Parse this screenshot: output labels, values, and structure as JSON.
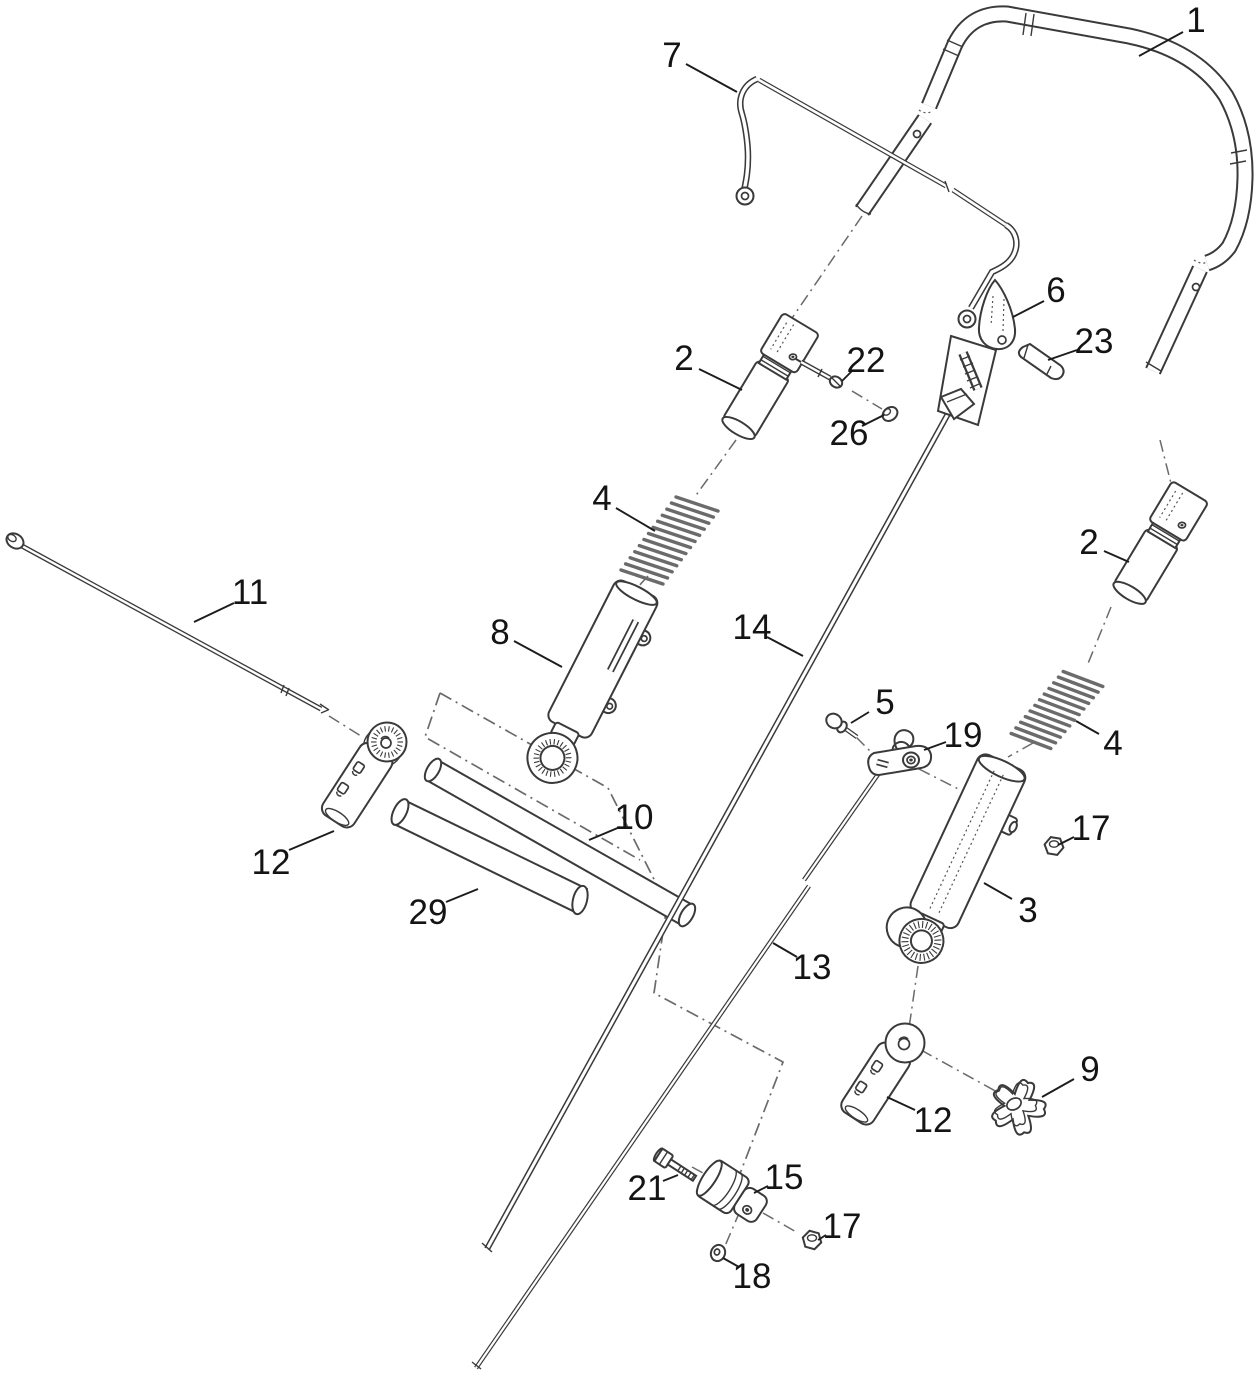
{
  "colors": {
    "background": "#ffffff",
    "line": "#3a3a3a",
    "phantom": "#6a6a6a",
    "label_text": "#141414",
    "spring": "#6b6b6b"
  },
  "callouts": [
    {
      "label": "1",
      "part": "upper-handle",
      "x": 1196,
      "y": 20,
      "l": [
        1183,
        32,
        1139,
        56
      ]
    },
    {
      "label": "7",
      "part": "bail-rod",
      "x": 672,
      "y": 55,
      "l": [
        686,
        64,
        737,
        92
      ]
    },
    {
      "label": "6",
      "part": "cam-lever",
      "x": 1056,
      "y": 290,
      "l": [
        1044,
        301,
        1013,
        317
      ]
    },
    {
      "label": "23",
      "part": "clevis-pin",
      "x": 1094,
      "y": 341,
      "l": [
        1077,
        350,
        1048,
        360
      ]
    },
    {
      "label": "2",
      "part": "trunnion-sleeve-left",
      "x": 684,
      "y": 358,
      "l": [
        699,
        369,
        742,
        390
      ]
    },
    {
      "label": "22",
      "part": "detent-pin",
      "x": 866,
      "y": 360,
      "l": [
        852,
        371,
        842,
        381
      ]
    },
    {
      "label": "26",
      "part": "push-cap",
      "x": 849,
      "y": 433,
      "l": [
        862,
        426,
        884,
        415
      ]
    },
    {
      "label": "4",
      "part": "spring-left",
      "x": 602,
      "y": 498,
      "l": [
        616,
        508,
        655,
        531
      ]
    },
    {
      "label": "2",
      "part": "trunnion-sleeve-right",
      "x": 1089,
      "y": 542,
      "l": [
        1104,
        551,
        1129,
        562
      ]
    },
    {
      "label": "11",
      "part": "handle-rod",
      "x": 250,
      "y": 592,
      "l": [
        234,
        603,
        194,
        622
      ]
    },
    {
      "label": "14",
      "part": "cable-rod-upper",
      "x": 752,
      "y": 627,
      "l": [
        767,
        637,
        803,
        656
      ]
    },
    {
      "label": "8",
      "part": "lever-arm-left",
      "x": 500,
      "y": 632,
      "l": [
        514,
        641,
        562,
        667
      ]
    },
    {
      "label": "5",
      "part": "shoulder-screw",
      "x": 885,
      "y": 702,
      "l": [
        869,
        712,
        851,
        723
      ]
    },
    {
      "label": "19",
      "part": "latch-plate",
      "x": 963,
      "y": 735,
      "l": [
        946,
        742,
        924,
        750
      ]
    },
    {
      "label": "4",
      "part": "spring-right",
      "x": 1113,
      "y": 743,
      "l": [
        1099,
        734,
        1076,
        721
      ]
    },
    {
      "label": "10",
      "part": "cross-tube",
      "x": 634,
      "y": 817,
      "l": [
        620,
        827,
        589,
        840
      ]
    },
    {
      "label": "17",
      "part": "flange-nut-right",
      "x": 1091,
      "y": 828,
      "l": [
        1074,
        837,
        1058,
        845
      ]
    },
    {
      "label": "12",
      "part": "clamp-bracket-left",
      "x": 271,
      "y": 862,
      "l": [
        289,
        850,
        334,
        831
      ]
    },
    {
      "label": "3",
      "part": "lever-arm-right",
      "x": 1028,
      "y": 910,
      "l": [
        1012,
        899,
        984,
        883
      ]
    },
    {
      "label": "29",
      "part": "spacer-tube",
      "x": 428,
      "y": 912,
      "l": [
        446,
        902,
        478,
        889
      ]
    },
    {
      "label": "13",
      "part": "cable-rod-lower",
      "x": 812,
      "y": 967,
      "l": [
        797,
        957,
        773,
        943
      ]
    },
    {
      "label": "9",
      "part": "star-knob",
      "x": 1090,
      "y": 1069,
      "l": [
        1074,
        1079,
        1042,
        1097
      ]
    },
    {
      "label": "12",
      "part": "clamp-bracket-right",
      "x": 933,
      "y": 1120,
      "l": [
        915,
        1110,
        887,
        1097
      ]
    },
    {
      "label": "15",
      "part": "trunnion-barrel",
      "x": 784,
      "y": 1177,
      "l": [
        768,
        1186,
        754,
        1193
      ]
    },
    {
      "label": "21",
      "part": "hex-bolt",
      "x": 647,
      "y": 1188,
      "l": [
        663,
        1181,
        678,
        1175
      ]
    },
    {
      "label": "17",
      "part": "flange-nut-bottom",
      "x": 842,
      "y": 1226,
      "l": [
        826,
        1235,
        818,
        1240
      ]
    },
    {
      "label": "18",
      "part": "washer",
      "x": 752,
      "y": 1276,
      "l": [
        739,
        1267,
        723,
        1258
      ]
    }
  ]
}
